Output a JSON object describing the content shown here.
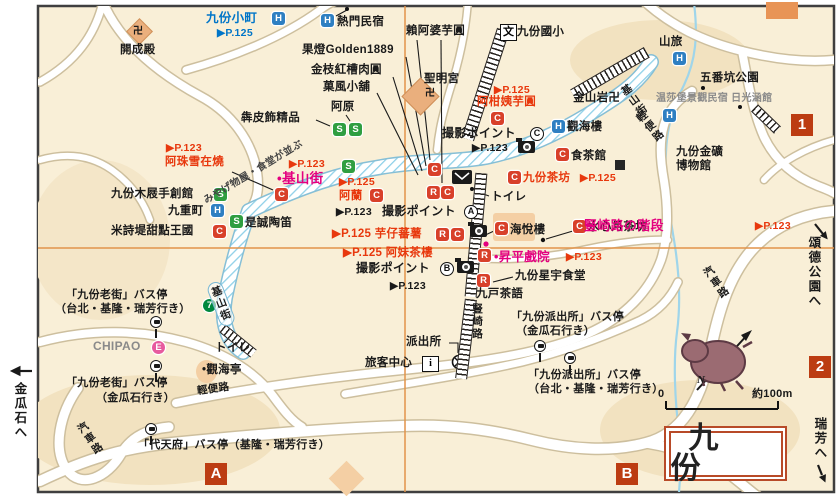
{
  "ic": {
    "h": "H",
    "s": "S",
    "c": "C",
    "r": "R",
    "e": "E",
    "seven": "7",
    "school": "文",
    "info": "i",
    "north": "N"
  },
  "grid": {
    "one": "1",
    "two": "2",
    "a": "A",
    "b": "B"
  },
  "frame": {
    "title": "九份",
    "scale_zero": "0",
    "scale_label": "約100m"
  },
  "offmap": {
    "left": "金瓜石へ",
    "park": "頌德公園へ",
    "ruifang": "瑞芳へ"
  },
  "streets": {
    "jishan_oval": "基山街",
    "jishan_tr": "基山街",
    "qingbian_b": "輕便路",
    "qingbian_t": "輕便路",
    "kisha_l": "汽車路",
    "kisha_r": "汽車路",
    "shuqi": "豎崎路",
    "arcade_note": "みやげ物屋・食堂が並ぶ"
  },
  "photo": {
    "label": "撮影ポイント",
    "page": "▶P.123",
    "a": "A",
    "b": "B",
    "c": "C"
  },
  "pois": {
    "komachi": {
      "name": "九份小町",
      "page": "▶P.125"
    },
    "kaiseiden": {
      "name": "開成殿",
      "manji": "卍"
    },
    "netsumon": {
      "name": "熱門民宿"
    },
    "raiapo": {
      "name": "賴阿婆芋圓"
    },
    "golden": {
      "name": "果燈Golden1889"
    },
    "kaneeda": {
      "name": "金枝紅槽肉圓"
    },
    "kafu": {
      "name": "菓風小舖"
    },
    "agen": {
      "name": "阿原"
    },
    "honpi": {
      "name": "犇皮飾精品"
    },
    "seimeigu": {
      "name": "聖明宮",
      "manji": "卍"
    },
    "school": {
      "name": "九份國小"
    },
    "akan": {
      "name": "阿柑姨芋圓",
      "page": "▶P.125"
    },
    "yamatabi": {
      "name": "山旅"
    },
    "gobanko": {
      "name": "五番坑公園"
    },
    "kinzangan": {
      "name": "金山岩卍"
    },
    "windsor": {
      "name": "温莎堡景觀民宿 日光涵館"
    },
    "kankairo": {
      "name": "觀海樓"
    },
    "shokakan": {
      "name": "食茶館"
    },
    "chabo": {
      "name": "九份茶坊",
      "page": "▶P.125"
    },
    "museum1": {
      "name": "九份金礦"
    },
    "museum2": {
      "name": "博物館"
    },
    "azhu": {
      "name": "阿珠雪在燒",
      "page": "▶P.123"
    },
    "mokuri": {
      "name": "九份木屐手創館"
    },
    "kokonoe": {
      "name": "九重町"
    },
    "mishidi": {
      "name": "米詩堤甜點王國"
    },
    "zecheng": {
      "name": "是誠陶笛"
    },
    "jishan_poi": {
      "name": "•基山街",
      "page": "▶P.123"
    },
    "alan": {
      "name": "阿蘭",
      "page": "▶P.125"
    },
    "imo": {
      "name": "▶P.125 芋仔蕃薯"
    },
    "amei": {
      "name": "▶P.125 阿妹茶樓"
    },
    "kaietsu": {
      "name": "海悅樓"
    },
    "suishin": {
      "name": "水心月茶坊"
    },
    "stairs": {
      "name": "豎崎路の階段",
      "page": "▶P.123"
    },
    "shohei": {
      "name": "•昇平戲院",
      "page": "▶P.123"
    },
    "seiu": {
      "name": "九份星宇食堂"
    },
    "kyuko": {
      "name": "九戸茶語"
    },
    "kankaitei": {
      "name": "•觀海亭"
    },
    "chipao": {
      "name": "CHIPAO"
    }
  },
  "fac": {
    "toilet": "トイレ",
    "toilet2": "トイレ",
    "police": "派出所",
    "visitor": "旅客中心"
  },
  "bus": {
    "b1n": "「九份老街」バス停",
    "b1d": "（台北・基隆・瑞芳行き）",
    "b2n": "「九份老街」バス停",
    "b2d": "（金瓜石行き）",
    "b3n": "「代天府」バス停（基隆・瑞芳行き）",
    "b4n": "「九份派出所」バス停",
    "b4d": "（金瓜石行き）",
    "b5n": "「九份派出所」バス停",
    "b5d": "（台北・基隆・瑞芳行き）"
  },
  "colors": {
    "page_red": "#e8380d",
    "feature_magenta": "#e4007f",
    "blue": "#0075c8",
    "hotel": "#2e7fc2",
    "shop": "#2f9e41",
    "food": "#d8402a",
    "grid_line": "#e2944a",
    "marker": "#bc3c12"
  }
}
